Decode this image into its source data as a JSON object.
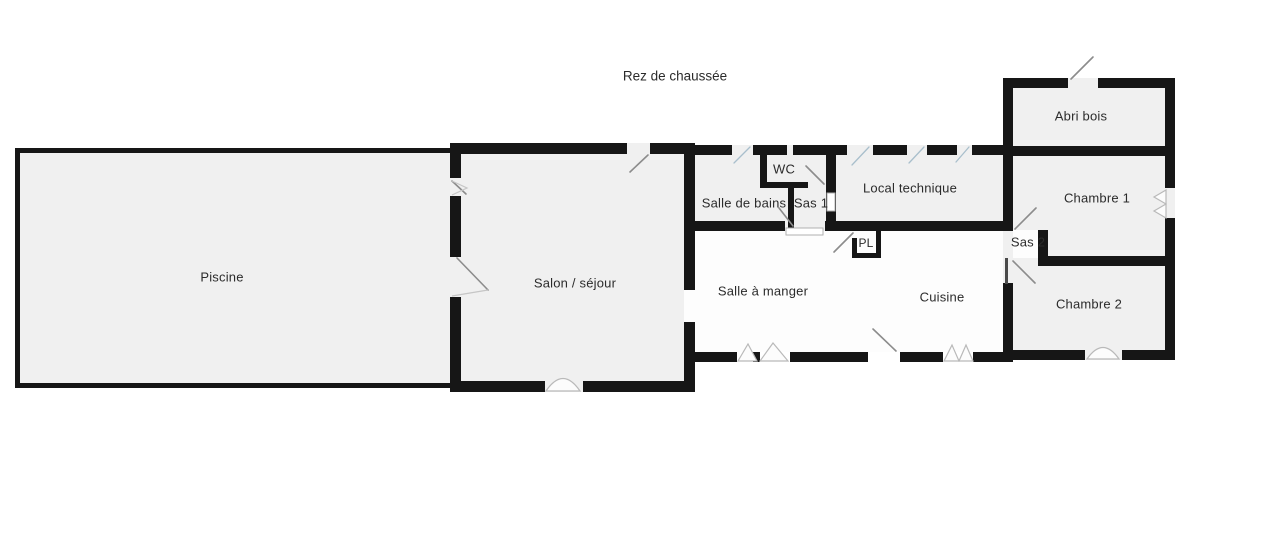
{
  "title": "Rez de chaussée",
  "rooms": {
    "piscine": "Piscine",
    "salon": "Salon / séjour",
    "salle_de_bains": "Salle de bains",
    "wc": "WC",
    "sas1": "Sas 1",
    "local_technique": "Local technique",
    "pl": "PL",
    "salle_a_manger": "Salle à manger",
    "cuisine": "Cuisine",
    "abri_bois": "Abri bois",
    "chambre1": "Chambre 1",
    "sas2": "Sas 2",
    "chambre2": "Chambre 2"
  },
  "colors": {
    "wall": "#161616",
    "room_fill": "#f0f0f0",
    "room_fill_light": "#fdfdfd",
    "swing": "#8c8c8c",
    "window_line": "#a9bfcc",
    "marker": "#b9b9b9",
    "text": "#2b2b2b"
  }
}
